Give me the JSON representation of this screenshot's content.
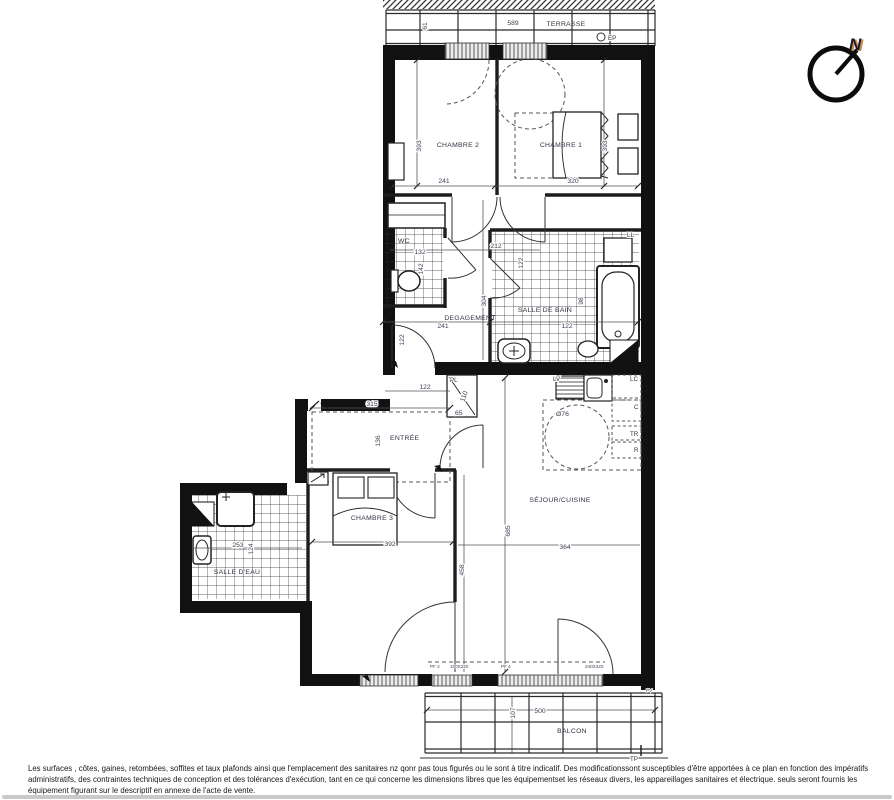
{
  "colors": {
    "wall": "#111111",
    "thin_wall": "#222222",
    "dim_text": "#3a4254",
    "north_accent": "#c8752c",
    "bottom_bar": "#c9c9c9"
  },
  "compass": {
    "north_label": "N"
  },
  "terrasse": {
    "label": "TERRASSE",
    "width_dim": "589",
    "depth_dim": "61",
    "ep_marker": "EP"
  },
  "chambre1": {
    "label": "CHAMBRE 1",
    "width_dim": "320",
    "depth_dim": "393"
  },
  "chambre2": {
    "label": "CHAMBRE 2",
    "width_dim": "241",
    "depth_dim": "393"
  },
  "wc": {
    "label": "WC",
    "width_dim": "132",
    "depth_dim": "142"
  },
  "degagement": {
    "label": "DEGAGEMENT",
    "width_dim": "241",
    "depth_dim": "304",
    "passage_dim": "212",
    "door_dim_a": "122",
    "door_dim_b": "122"
  },
  "salle_de_bain": {
    "label": "SALLE DE BAIN",
    "width_dim": "122",
    "tub_dim": "98",
    "washer_label": "LL"
  },
  "entree": {
    "label": "ENTRÉE",
    "width_dim": "315",
    "depth_dim": "136",
    "passage_dim": "122"
  },
  "placard": {
    "label": "PL",
    "height_dim": "110",
    "width_dim": "65"
  },
  "cuisine": {
    "dishwasher_label": "LV",
    "top_unit_label": "LC",
    "unit_c_label": "C",
    "unit_tr_label": "TR",
    "unit_r_label": "R",
    "circle_dim": "Ø76"
  },
  "sejour": {
    "label": "SÉJOUR/CUISINE",
    "width_dim": "364",
    "depth_dim": "685"
  },
  "chambre3": {
    "label": "CHAMBRE 3",
    "width_dim": "392",
    "depth_dim": "458"
  },
  "salle_deau": {
    "label": "SALLE D'EAU",
    "width_dim": "253",
    "depth_dim": "124"
  },
  "balcon": {
    "label": "BALCON",
    "width_dim": "500",
    "depth_dim": "107",
    "tp_marker": "TP",
    "pv_marker": "PV"
  },
  "window_tags": {
    "pf2": "PF 2",
    "pf2_size": "100X220",
    "pf4": "PF 4",
    "pf4_size": "240X220"
  },
  "disclaimer": {
    "line1": "Les surfaces , côtes, gaines, retombées, soffites et taux plafonds ainsi que l'emplacement des sanitaires nz qonr pas tous figurés ou le sont à titre indicatif. Des modificationssont susceptibles d'être apportées à ce plan en fonction des impératifs",
    "line2": "administratifs, des contraintes techniques de conception et des tolérances d'exécution, tant en ce qui concerne les dimensions libres que les équipementset les réseaux divers, les appareillages sanitaires et électrique. seuls seront fournis les",
    "line3": "équipement figurant sur le descriptif en annexe de l'acte de vente."
  }
}
